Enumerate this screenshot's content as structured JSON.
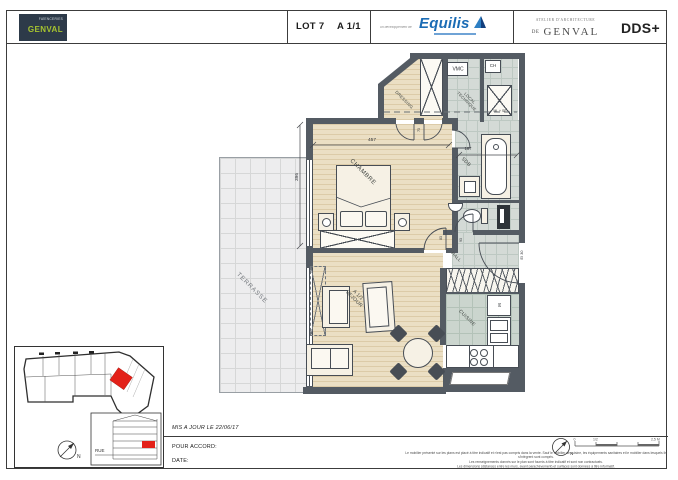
{
  "header": {
    "logo_top": "FAÏENCERIES",
    "logo_name": "GENVAL",
    "lot": "LOT 7",
    "sheet": "A 1/1",
    "dev_prefix": "un développement de",
    "dev_name": "Equilis",
    "arch_line1": "ATELIER D'ARCHITECTURE",
    "arch_de": "DE",
    "arch_name": "GENVAL",
    "arch_brand": "DDS+"
  },
  "plan": {
    "terrasse": "TERRASSE",
    "chambre": "CHAMBRE",
    "sejour_1": "A 1/1",
    "sejour_2": "SEJOUR",
    "cuisine": "CUISINE",
    "hall": "HALL",
    "sdb": "SDB",
    "dressing": "DRESSING",
    "local_1": "LOCAL",
    "local_2": "TECHNIQUE",
    "vmc": "VMC",
    "ch": "CH",
    "ml_se": "ML + SE",
    "m": "M",
    "fire_rating": "EI 30",
    "dim_width": "457",
    "dim_height": "396",
    "dim_sdb": "187",
    "door_1": "93",
    "door_2": "83",
    "door_3": "73"
  },
  "keyplan": {
    "rue": "RUE",
    "north": "N"
  },
  "footer": {
    "updated": "MIS A JOUR LE 22/06/17",
    "accord": "POUR ACCORD:",
    "date": "DATE:",
    "north": "N",
    "scale_0": "0",
    "scale_mid": "1/2",
    "scale_end": "2,5 M",
    "disclaimer_1": "Le mobilier présenté sur les plans est placé à titre indicatif et n'est pas compris dans la vente. Sauf le mobilier de cuisine, les équipements sanitaires et le mobilier dans lesquels ils s'intègrent sont compris.",
    "disclaimer_2": "Les renseignements donnés sur le plan sont fournis à titre indicatif et sont non contractuels.",
    "disclaimer_3": "Les dimensions (distances entre les murs, avant parachèvement) et surfaces sont données à titre informatif."
  }
}
